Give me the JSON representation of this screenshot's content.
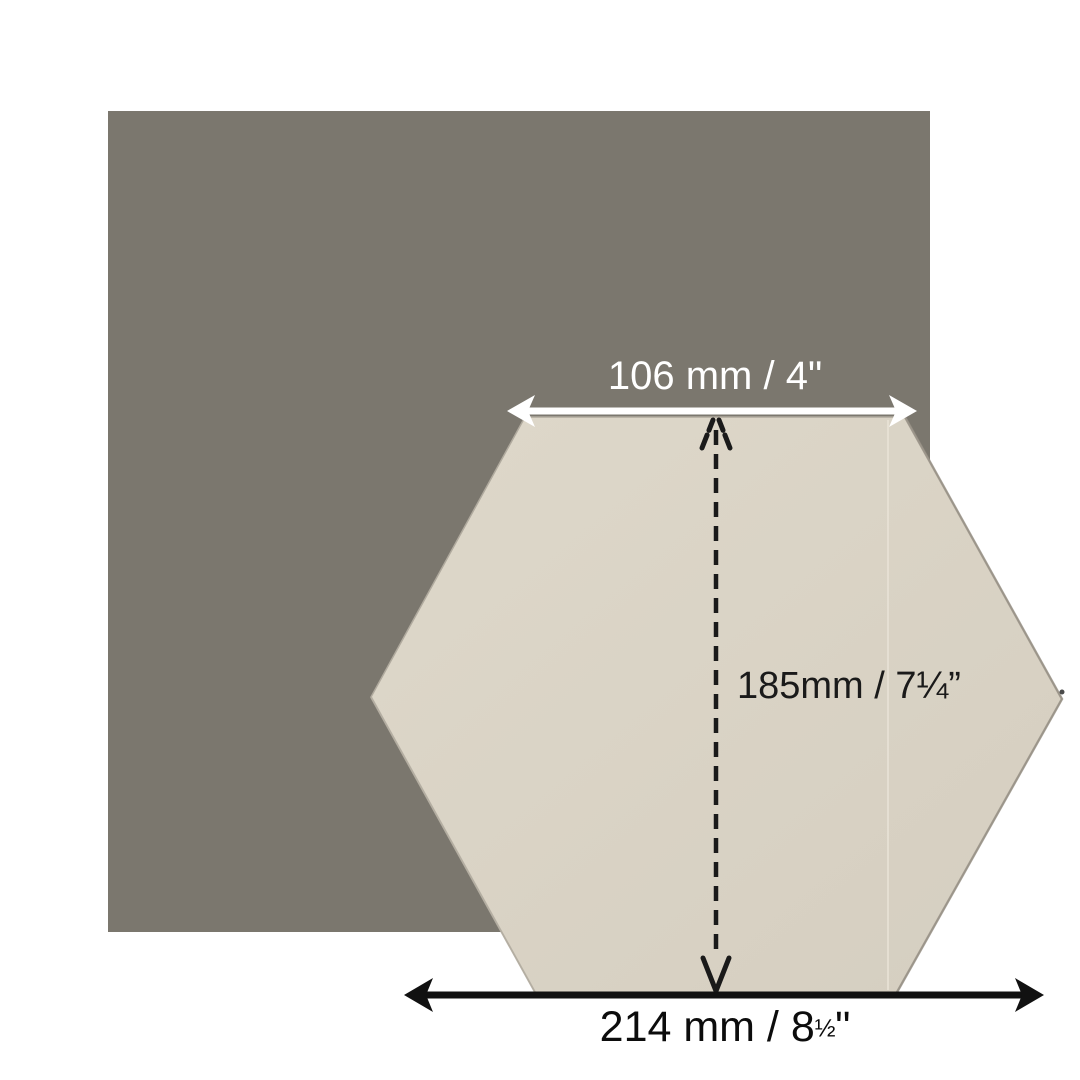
{
  "diagram": {
    "description": "Hexagon tile dimension diagram over a square background tile",
    "labels": {
      "top_width": "106 mm / 4\"",
      "diagonal_height": "185mm / 7¼”",
      "bottom_width_prefix": "214 mm / 8",
      "bottom_width_fraction": "½",
      "bottom_width_suffix": "\""
    },
    "measurements": [
      {
        "name": "top-edge-width",
        "value_mm": 106,
        "value_inches": "4\""
      },
      {
        "name": "top-to-bottom-height",
        "value_mm": 185,
        "value_inches": "7¼\""
      },
      {
        "name": "point-to-point-width",
        "value_mm": 214,
        "value_inches": "8½\""
      }
    ],
    "colors": {
      "background": "#ffffff",
      "square": "#7b776e",
      "tile_light": "#ded8ca",
      "tile_dark": "#d5cec0",
      "tile_edge": "#b0aa9e",
      "dimension_white": "#ffffff",
      "dimension_black": "#111111",
      "text_dark": "#1a1a1a"
    }
  }
}
